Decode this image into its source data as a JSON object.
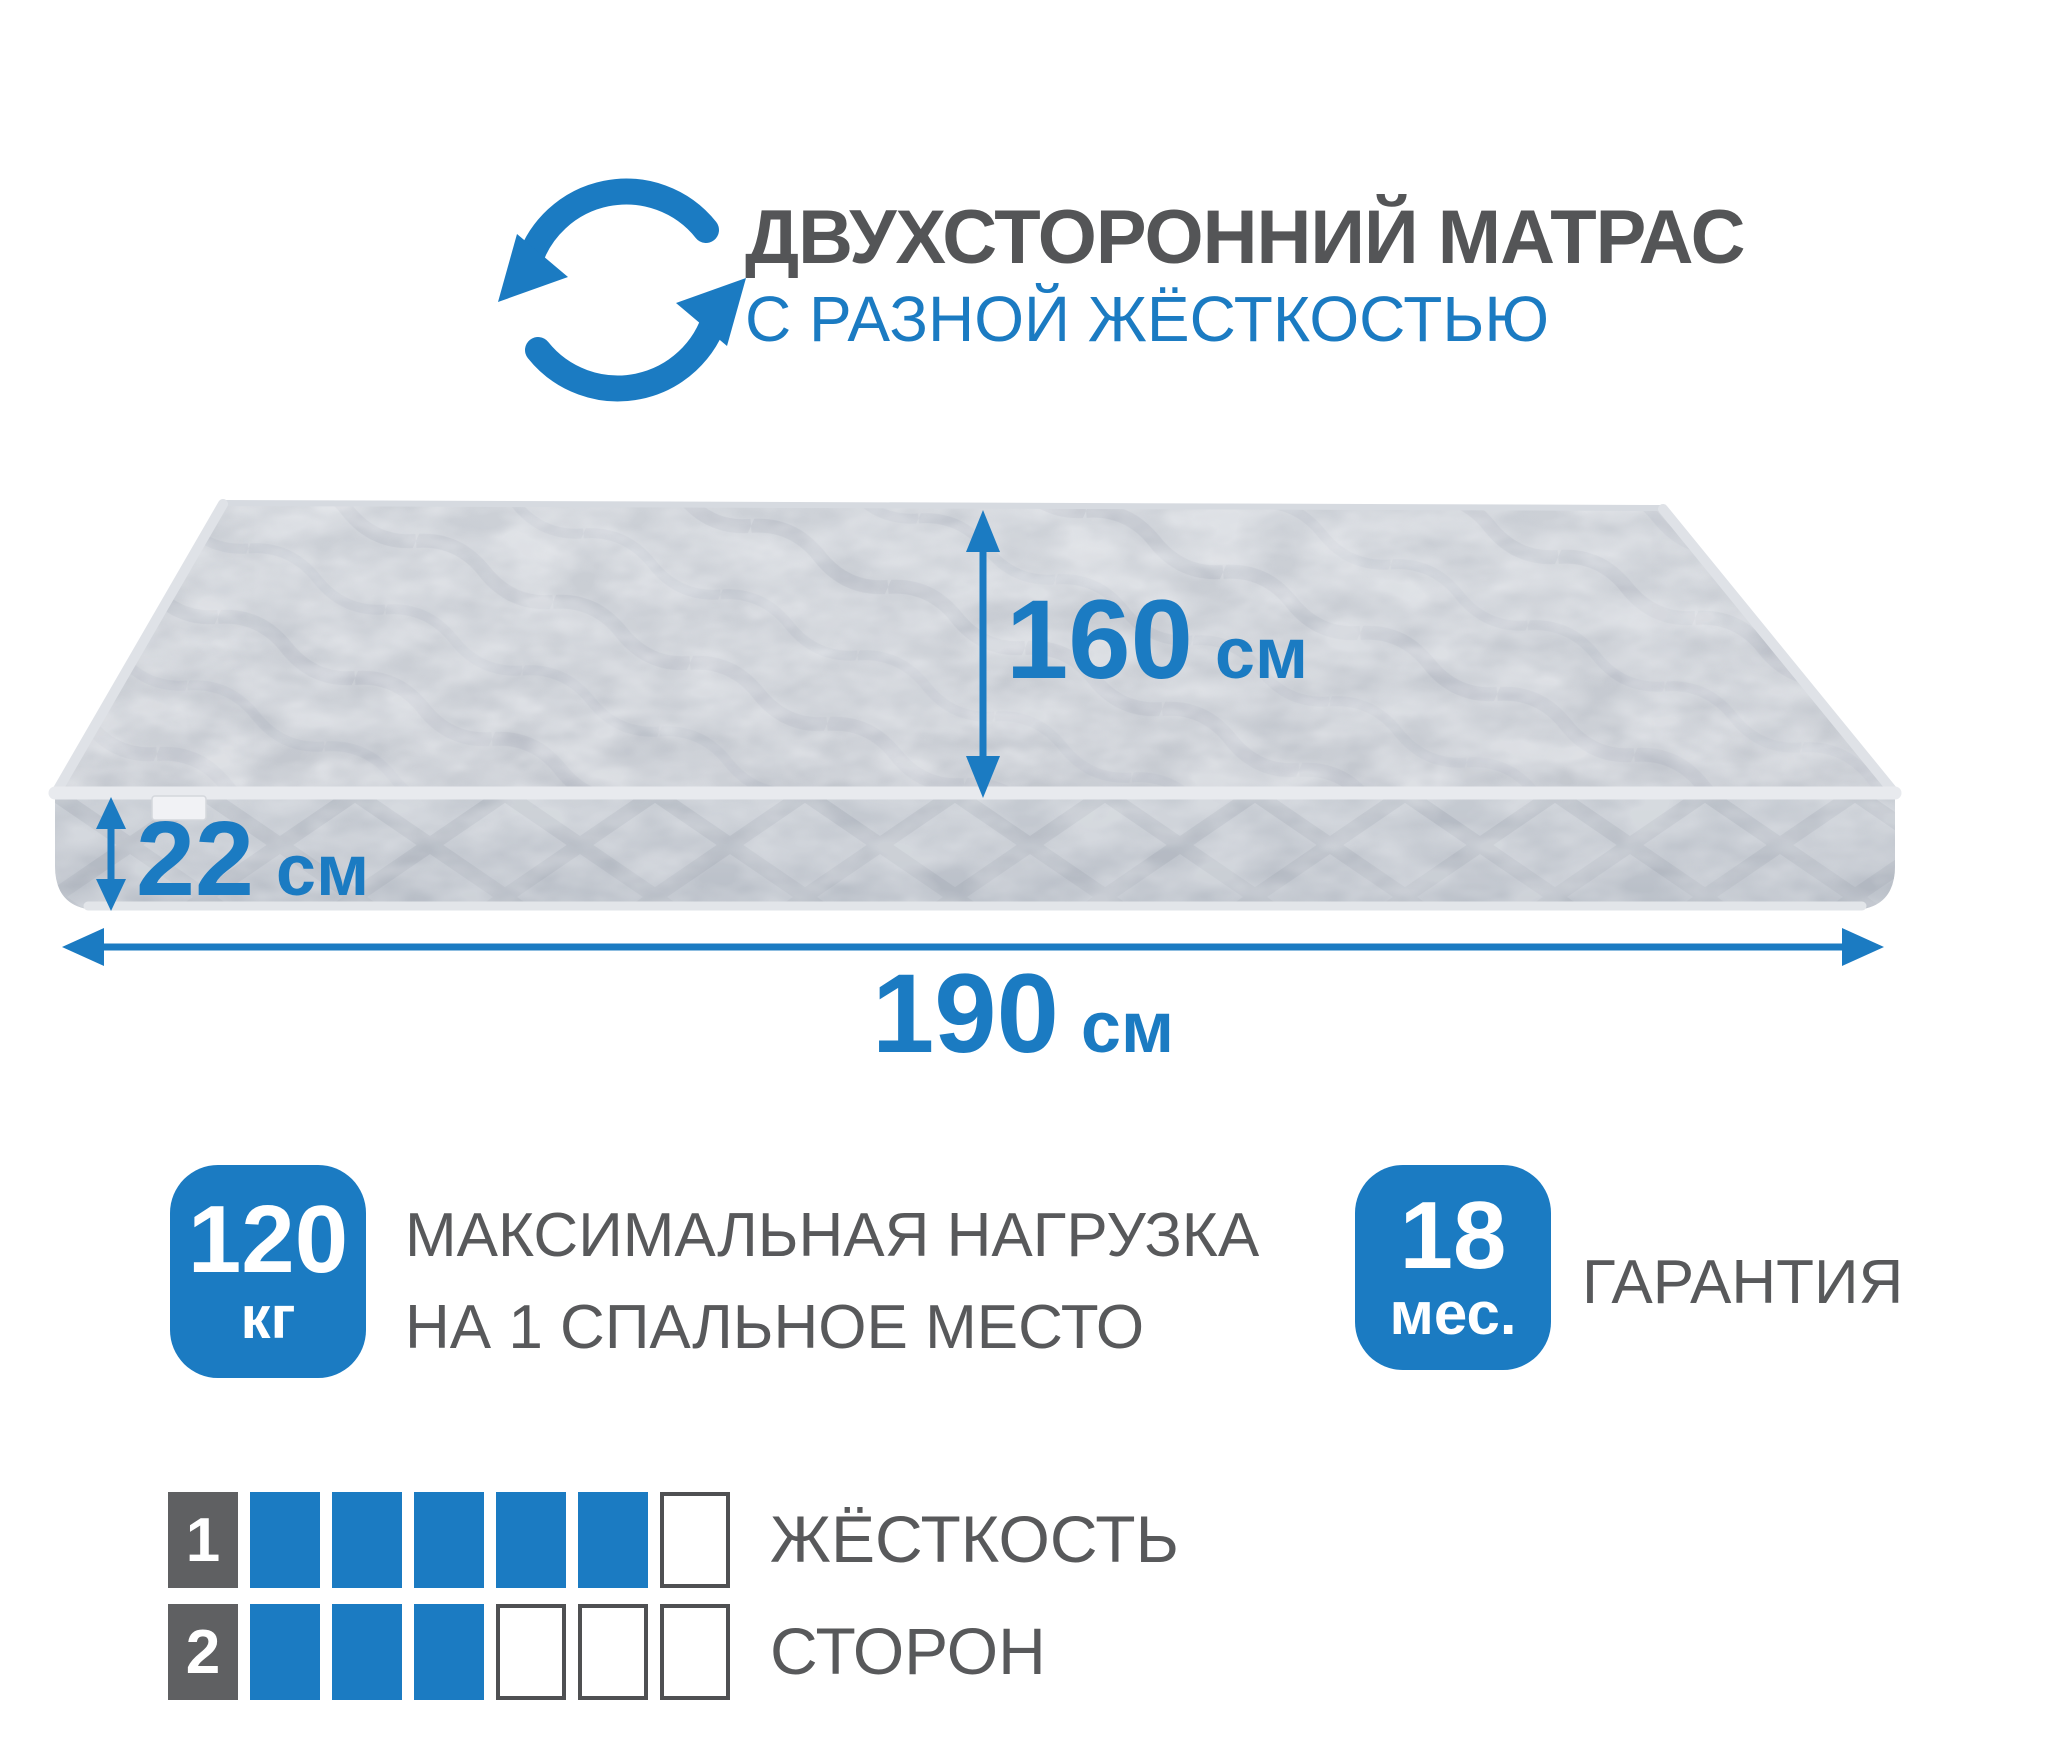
{
  "colors": {
    "accent": "#1b7bc2",
    "title_gray": "#545557",
    "text_gray": "#58595b",
    "label_square_gray": "#5f6062",
    "square_border_gray": "#4f5052"
  },
  "header": {
    "icon": "rotate-arrows-icon",
    "title": "ДВУХСТОРОННИЙ МАТРАС",
    "subtitle": "С РАЗНОЙ ЖЁСТКОСТЬЮ"
  },
  "dimensions": {
    "width": {
      "value": "160",
      "unit": "см"
    },
    "height": {
      "value": "22",
      "unit": "см"
    },
    "length": {
      "value": "190",
      "unit": "см"
    }
  },
  "badges": {
    "max_load": {
      "value": "120",
      "unit": "кг",
      "caption_line1": "МАКСИМАЛЬНАЯ НАГРУЗКА",
      "caption_line2": "НА 1 СПАЛЬНОЕ МЕСТО"
    },
    "warranty": {
      "value": "18",
      "unit": "мес.",
      "caption": "ГАРАНТИЯ"
    }
  },
  "hardness": {
    "caption_line1": "ЖЁСТКОСТЬ",
    "caption_line2": "СТОРОН",
    "rows": [
      {
        "side": "1",
        "filled": 5,
        "total": 6
      },
      {
        "side": "2",
        "filled": 3,
        "total": 6
      }
    ]
  }
}
